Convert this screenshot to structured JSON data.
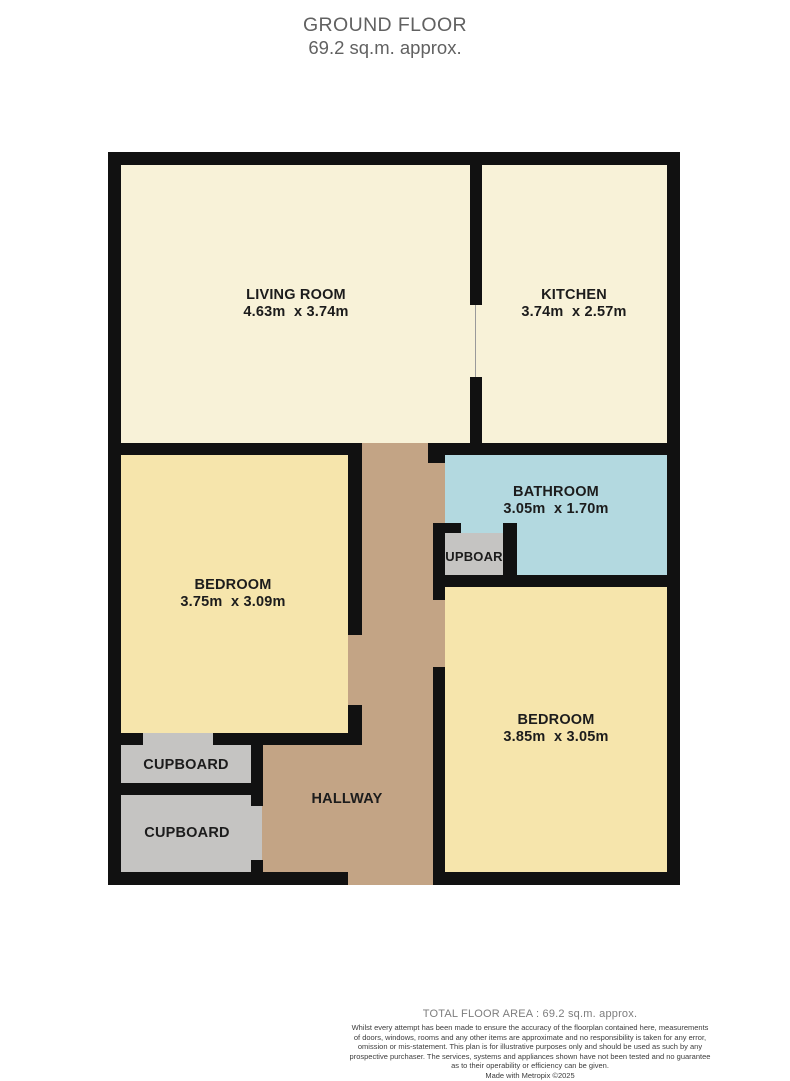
{
  "colors": {
    "wall": "#111111",
    "living_kitchen_floor": "#F8F2D8",
    "bedroom_floor": "#F6E5AC",
    "bathroom_floor": "#B3D9E0",
    "hallway_floor": "#C3A485",
    "cupboard_floor": "#C5C4C2"
  },
  "header": {
    "title": "GROUND FLOOR",
    "subtitle": "69.2 sq.m. approx."
  },
  "rooms": {
    "living_room": {
      "name": "LIVING ROOM",
      "dims": "4.63m  x 3.74m"
    },
    "kitchen": {
      "name": "KITCHEN",
      "dims": "3.74m  x 2.57m"
    },
    "bathroom": {
      "name": "BATHROOM",
      "dims": "3.05m  x 1.70m"
    },
    "bedroom_left": {
      "name": "BEDROOM",
      "dims": "3.75m  x 3.09m"
    },
    "bedroom_right": {
      "name": "BEDROOM",
      "dims": "3.85m  x 3.05m"
    },
    "hallway": {
      "name": "HALLWAY"
    },
    "cupboard_bathroom": {
      "name": "CUPBOARD"
    },
    "cupboard_upper": {
      "name": "CUPBOARD"
    },
    "cupboard_lower": {
      "name": "CUPBOARD"
    }
  },
  "footer": {
    "total_area": "TOTAL FLOOR AREA : 69.2 sq.m. approx.",
    "disclaimer_lines": [
      "Whilst every attempt has been made to ensure the accuracy of the floorplan contained here, measurements",
      "of doors, windows, rooms and any other items are approximate and no responsibility is taken for any error,",
      "omission or mis-statement. This plan is for illustrative purposes only and should be used as such by any",
      "prospective purchaser. The services, systems and appliances shown have not been tested and no guarantee",
      "as to their operability or efficiency can be given."
    ],
    "credit": "Made with Metropix ©2025"
  }
}
